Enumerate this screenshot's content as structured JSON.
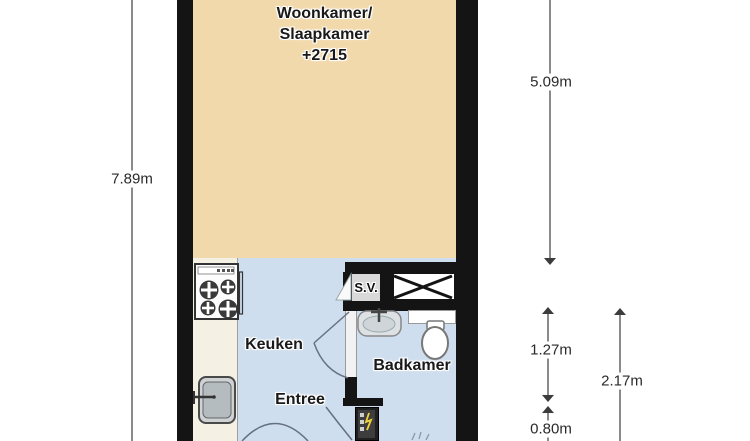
{
  "rooms": {
    "living": {
      "name": "Woonkamer/",
      "name2": "Slaapkamer",
      "height_code": "+2715"
    },
    "kitchen": {
      "name": "Keuken"
    },
    "hall": {
      "name": "Entree"
    },
    "bathroom": {
      "name": "Badkamer"
    },
    "shaft": {
      "name": "S.V."
    }
  },
  "dimensions": {
    "total_height_left": "7.89m",
    "living_height_right": "5.09m",
    "bathroom_height": "1.27m",
    "entry_depth": "0.80m",
    "lower_section_height": "2.17m"
  },
  "colors": {
    "floor-living": "#f2d9ab",
    "floor-wet": "#cfdeee",
    "counter": "#f4f0e3",
    "wall": "#141414",
    "dimension-line": "#3c3c3c"
  }
}
